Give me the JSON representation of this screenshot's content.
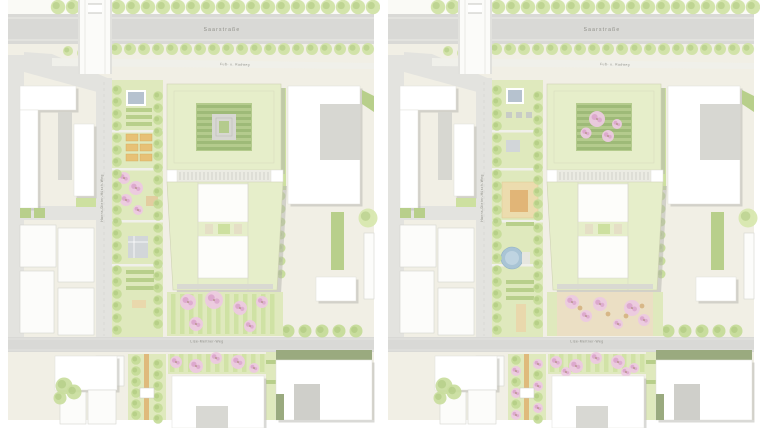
{
  "panels": [
    {
      "id": "variant-a",
      "labels": {
        "street_top": "Saarstraße",
        "path_diagonal": "Fuß- u. Radweg",
        "street_left": "Hanns-Dieter-Hüsch-Weg",
        "street_bottom": "Lise-Meitner-Weg"
      }
    },
    {
      "id": "variant-b",
      "labels": {
        "street_top": "Saarstraße",
        "path_diagonal": "Fuß- u. Radweg",
        "street_left": "Hanns-Dieter-Hüsch-Weg",
        "street_bottom": "Lise-Meitner-Weg"
      }
    }
  ],
  "colors": {
    "ground": "#f1efe5",
    "ground_top": "#fafaf6",
    "road": "#d9d9d6",
    "road_light": "#e3e3df",
    "curb": "#f0f0ea",
    "shadow": "#b3b3ae",
    "outline": "#e0e0da",
    "roof_new": "#e6eeca",
    "roof_line": "#cfd2b4",
    "court_green": "#b4cb8d",
    "court_dark": "#97b471",
    "inner_gray": "#d7d7d2",
    "tree_street": "#cfe2a4",
    "tree_fill": "#c4db97",
    "tree_dark": "#a3c274",
    "lawn": "#dfe9bd",
    "lawn2": "#cde0a0",
    "hedge": "#b8cf8b",
    "blossom": "#ecc9e0",
    "blossom_dark": "#d9a0c9",
    "trunk": "#a08264",
    "tan": "#e9d8ac",
    "orange": "#dfa967",
    "plaza": "#ebdfc4",
    "planter": "#d7b787",
    "dark_roof": "#9aaa7f",
    "water": "#a9c4d5",
    "pavilion": "#b6c2cf",
    "pavilion2": "#d2d6d9",
    "mews": "#ebebe3",
    "tick": "#c2c2ba",
    "label_text": "#8d8d86"
  }
}
